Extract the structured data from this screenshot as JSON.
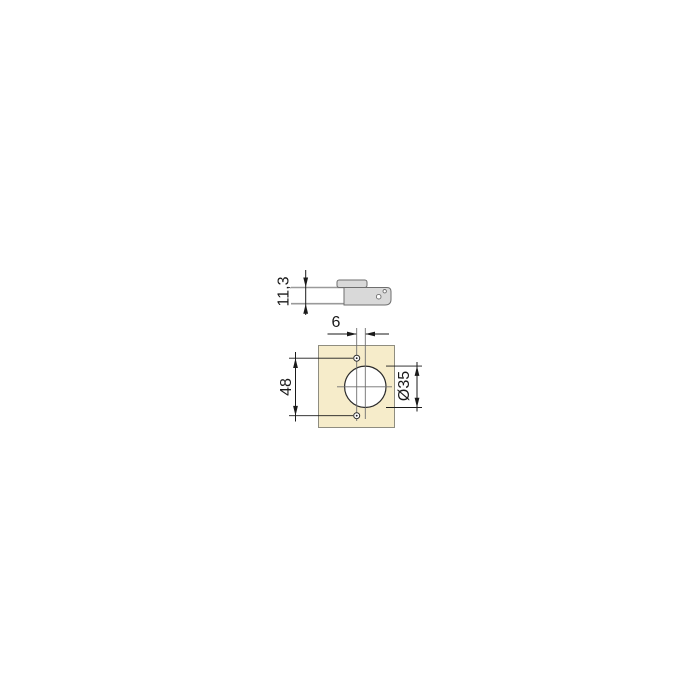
{
  "drawing": {
    "side_view": {
      "cup_depth_label": "11,3"
    },
    "plan_view": {
      "center_offset_label": "6",
      "hole_spacing_label": "48",
      "cup_diameter_label": "Ø35"
    }
  },
  "colors": {
    "background": "#ffffff",
    "panel_fill": "#f6ecca",
    "metal_fill": "#d9d9d9",
    "line": "#1a1a1a",
    "centerline": "#6f6f6f"
  }
}
